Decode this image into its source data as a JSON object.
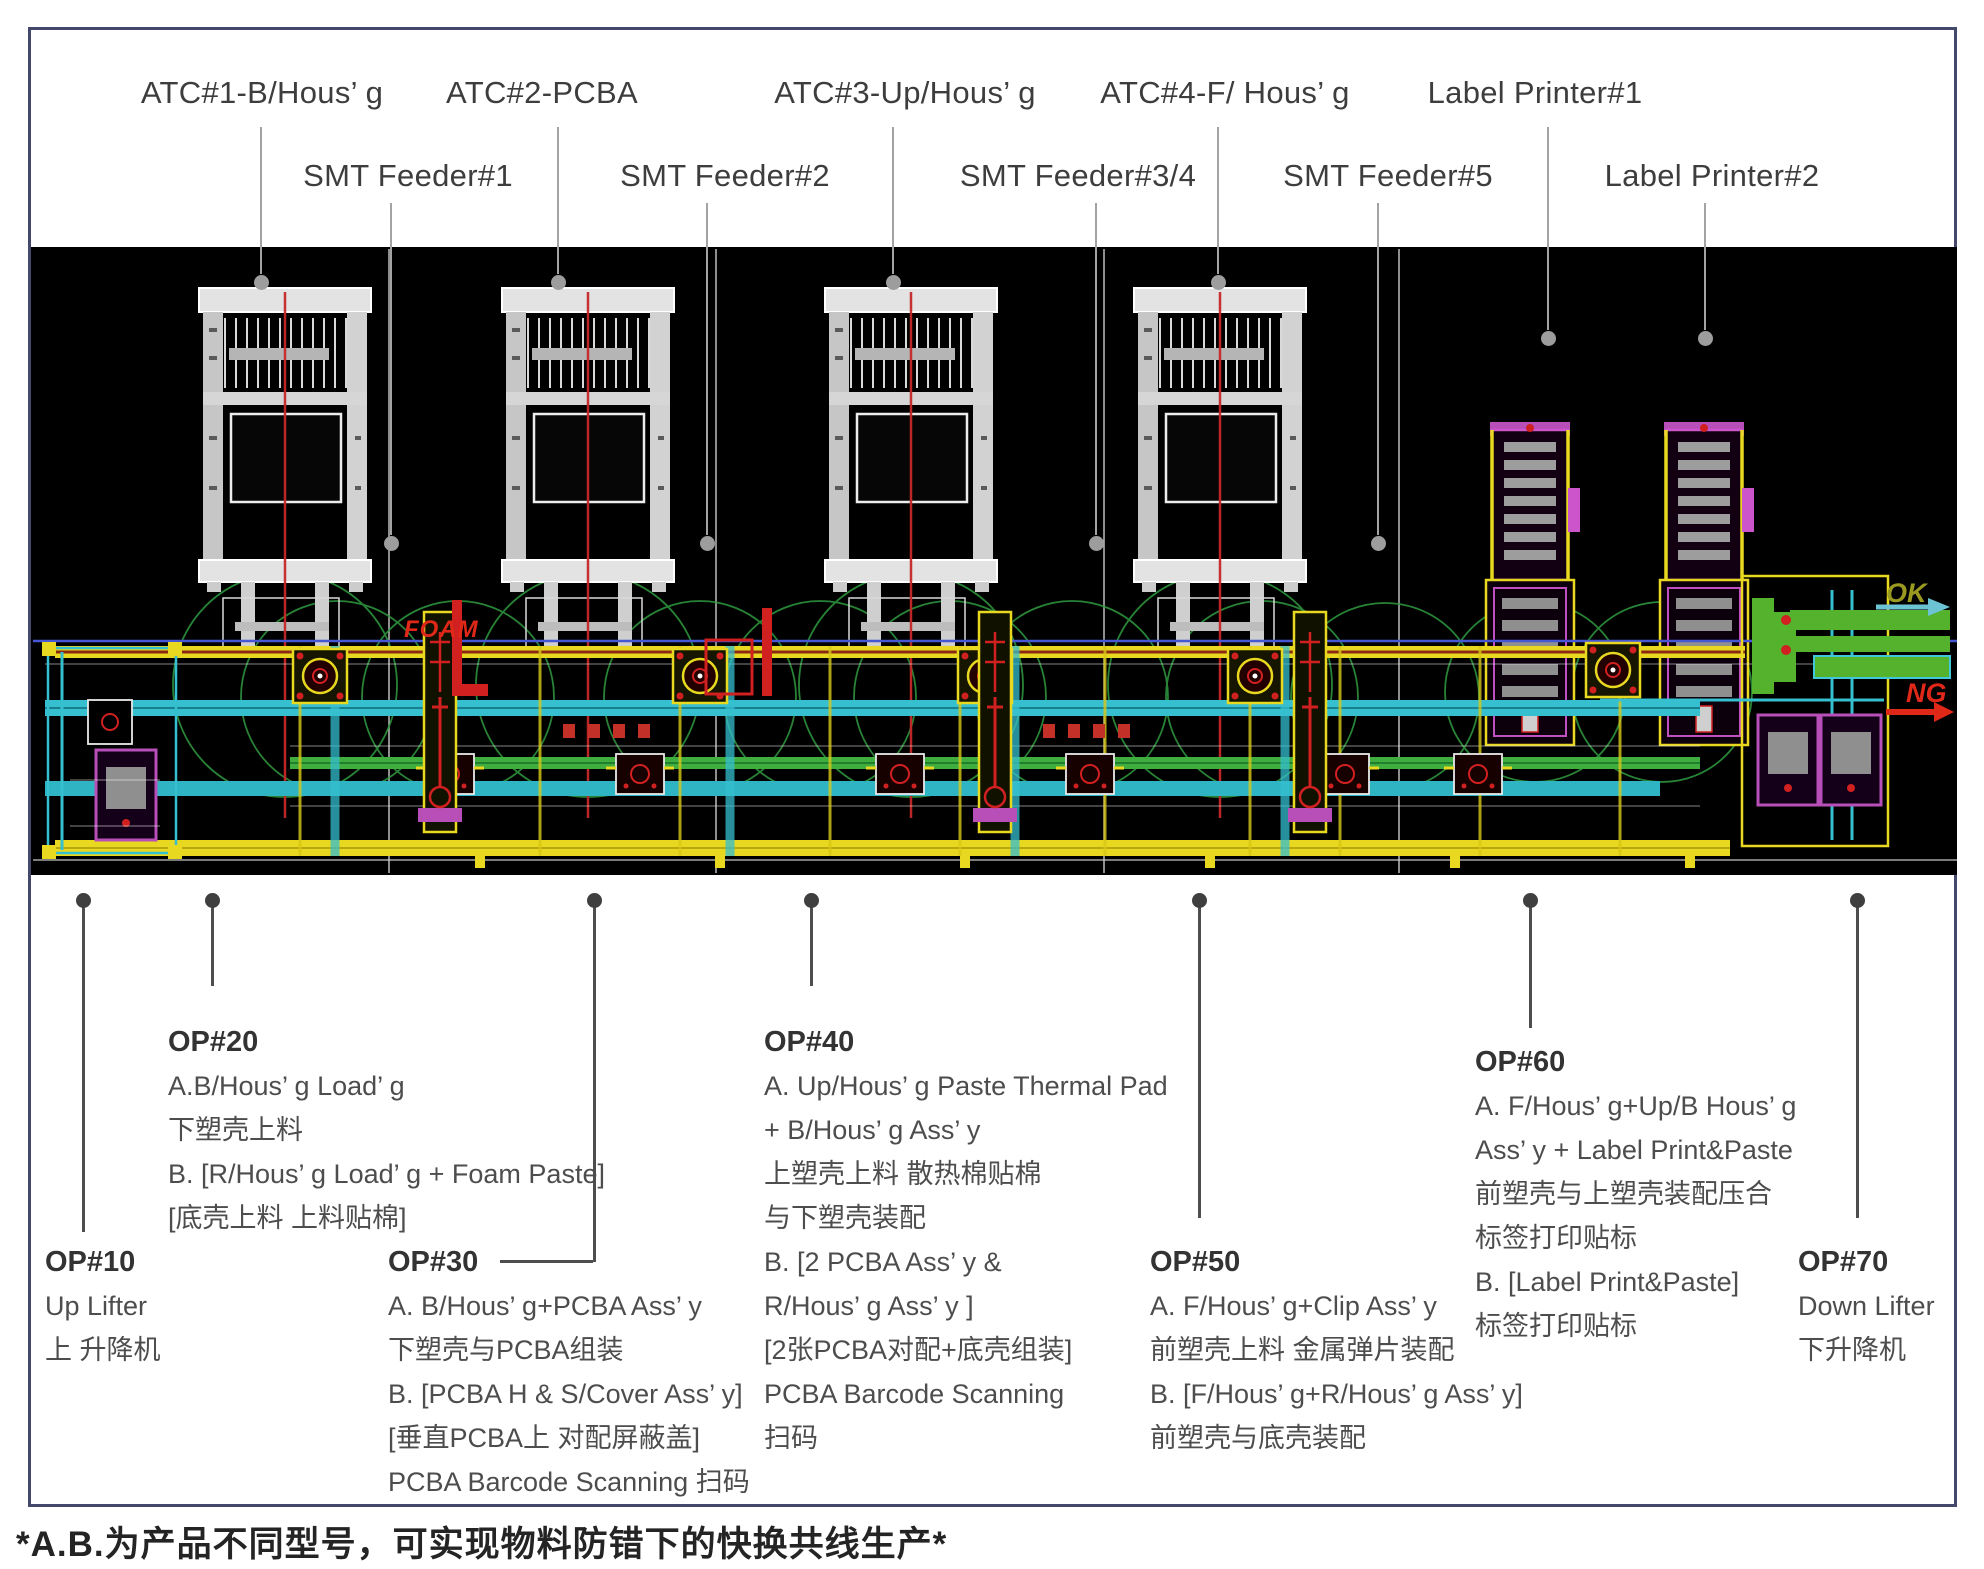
{
  "footnote": "*A.B.为产品不同型号，可实现物料防错下的快换共线生产*",
  "cad": {
    "foam": "FOAM",
    "ok": "OK",
    "ng": "NG"
  },
  "colors": {
    "frame_border": "#44496b",
    "cad_background": "#000000",
    "accent_yellow": "#e8d820",
    "accent_cyan": "#35bfcf",
    "accent_green": "#55b22d",
    "envelope_green": "#2f9b40",
    "accent_red": "#d02020",
    "accent_magenta": "#b84fb8",
    "machine_white": "#e3e3e3",
    "callout_gray": "#9d9d9d",
    "callout_dark": "#4e4e4e"
  },
  "top_callouts": [
    {
      "id": "atc-1",
      "label": "ATC#1-B/Hous’ g",
      "row": 1,
      "text_x": 262,
      "line_x": 261,
      "line_top": 127,
      "line_bottom": 274,
      "dot_y": 282
    },
    {
      "id": "atc-2",
      "label": "ATC#2-PCBA",
      "row": 1,
      "text_x": 542,
      "line_x": 558,
      "line_top": 127,
      "line_bottom": 274,
      "dot_y": 282
    },
    {
      "id": "atc-3",
      "label": "ATC#3-Up/Hous’ g",
      "row": 1,
      "text_x": 905,
      "line_x": 893,
      "line_top": 127,
      "line_bottom": 274,
      "dot_y": 282
    },
    {
      "id": "atc-4",
      "label": "ATC#4-F/ Hous’ g",
      "row": 1,
      "text_x": 1225,
      "line_x": 1218,
      "line_top": 127,
      "line_bottom": 274,
      "dot_y": 282
    },
    {
      "id": "label-printer-1",
      "label": "Label Printer#1",
      "row": 1,
      "text_x": 1535,
      "line_x": 1548,
      "line_top": 127,
      "line_bottom": 330,
      "dot_y": 338
    },
    {
      "id": "smt-feeder-1",
      "label": "SMT Feeder#1",
      "row": 2,
      "text_x": 408,
      "line_x": 391,
      "line_top": 203,
      "line_bottom": 535,
      "dot_y": 543
    },
    {
      "id": "smt-feeder-2",
      "label": "SMT Feeder#2",
      "row": 2,
      "text_x": 725,
      "line_x": 707,
      "line_top": 203,
      "line_bottom": 535,
      "dot_y": 543
    },
    {
      "id": "smt-feeder-34",
      "label": "SMT Feeder#3/4",
      "row": 2,
      "text_x": 1078,
      "line_x": 1096,
      "line_top": 203,
      "line_bottom": 535,
      "dot_y": 543
    },
    {
      "id": "smt-feeder-5",
      "label": "SMT Feeder#5",
      "row": 2,
      "text_x": 1388,
      "line_x": 1378,
      "line_top": 203,
      "line_bottom": 535,
      "dot_y": 543
    },
    {
      "id": "label-printer-2",
      "label": "Label Printer#2",
      "row": 2,
      "text_x": 1712,
      "line_x": 1705,
      "line_top": 203,
      "line_bottom": 330,
      "dot_y": 338
    }
  ],
  "bottom_callouts": [
    {
      "id": "op10",
      "title": "OP#10",
      "dot_x": 83,
      "line_bottom": 1232,
      "block_x": 45,
      "block_y": 1240,
      "lines": [
        "Up Lifter",
        "上 升降机"
      ]
    },
    {
      "id": "op20",
      "title": "OP#20",
      "dot_x": 212,
      "line_bottom": 986,
      "block_x": 168,
      "block_y": 1020,
      "lines": [
        "A.B/Hous’ g Load’ g",
        "下塑壳上料",
        "B. [R/Hous’ g Load’ g + Foam Paste]",
        "[底壳上料 上料贴棉]"
      ]
    },
    {
      "id": "op30",
      "title": "OP#30",
      "dot_x": 594,
      "line_bottom": 1262,
      "block_x": 388,
      "block_y": 1240,
      "connector": {
        "x1": 500,
        "x2": 593,
        "y": 1260
      },
      "lines": [
        "A. B/Hous’ g+PCBA Ass’ y",
        "下塑壳与PCBA组装",
        "B. [PCBA H & S/Cover Ass’ y]",
        "[垂直PCBA上 对配屏蔽盖]",
        "PCBA Barcode Scanning 扫码"
      ]
    },
    {
      "id": "op40",
      "title": "OP#40",
      "dot_x": 811,
      "line_bottom": 986,
      "block_x": 764,
      "block_y": 1020,
      "lines": [
        "A. Up/Hous’ g Paste Thermal Pad",
        "+ B/Hous’ g Ass’ y",
        "上塑壳上料 散热棉贴棉",
        "与下塑壳装配",
        "B. [2 PCBA Ass’ y &",
        "R/Hous’ g Ass’ y ]",
        "[2张PCBA对配+底壳组装]",
        "PCBA Barcode Scanning",
        "扫码"
      ]
    },
    {
      "id": "op50",
      "title": "OP#50",
      "dot_x": 1199,
      "line_bottom": 1218,
      "block_x": 1150,
      "block_y": 1240,
      "lines": [
        "A. F/Hous’ g+Clip Ass’ y",
        "前塑壳上料 金属弹片装配",
        "B. [F/Hous’ g+R/Hous’ g Ass’ y]",
        "前塑壳与底壳装配"
      ]
    },
    {
      "id": "op60",
      "title": "OP#60",
      "dot_x": 1530,
      "line_bottom": 1028,
      "block_x": 1475,
      "block_y": 1040,
      "lines": [
        "A. F/Hous’ g+Up/B Hous’ g",
        "Ass’ y + Label Print&Paste",
        "前塑壳与上塑壳装配压合",
        "标签打印贴标",
        "B. [Label Print&Paste]",
        "标签打印贴标"
      ]
    },
    {
      "id": "op70",
      "title": "OP#70",
      "dot_x": 1857,
      "line_bottom": 1218,
      "block_x": 1798,
      "block_y": 1240,
      "lines": [
        "Down Lifter",
        "下升降机"
      ]
    }
  ]
}
